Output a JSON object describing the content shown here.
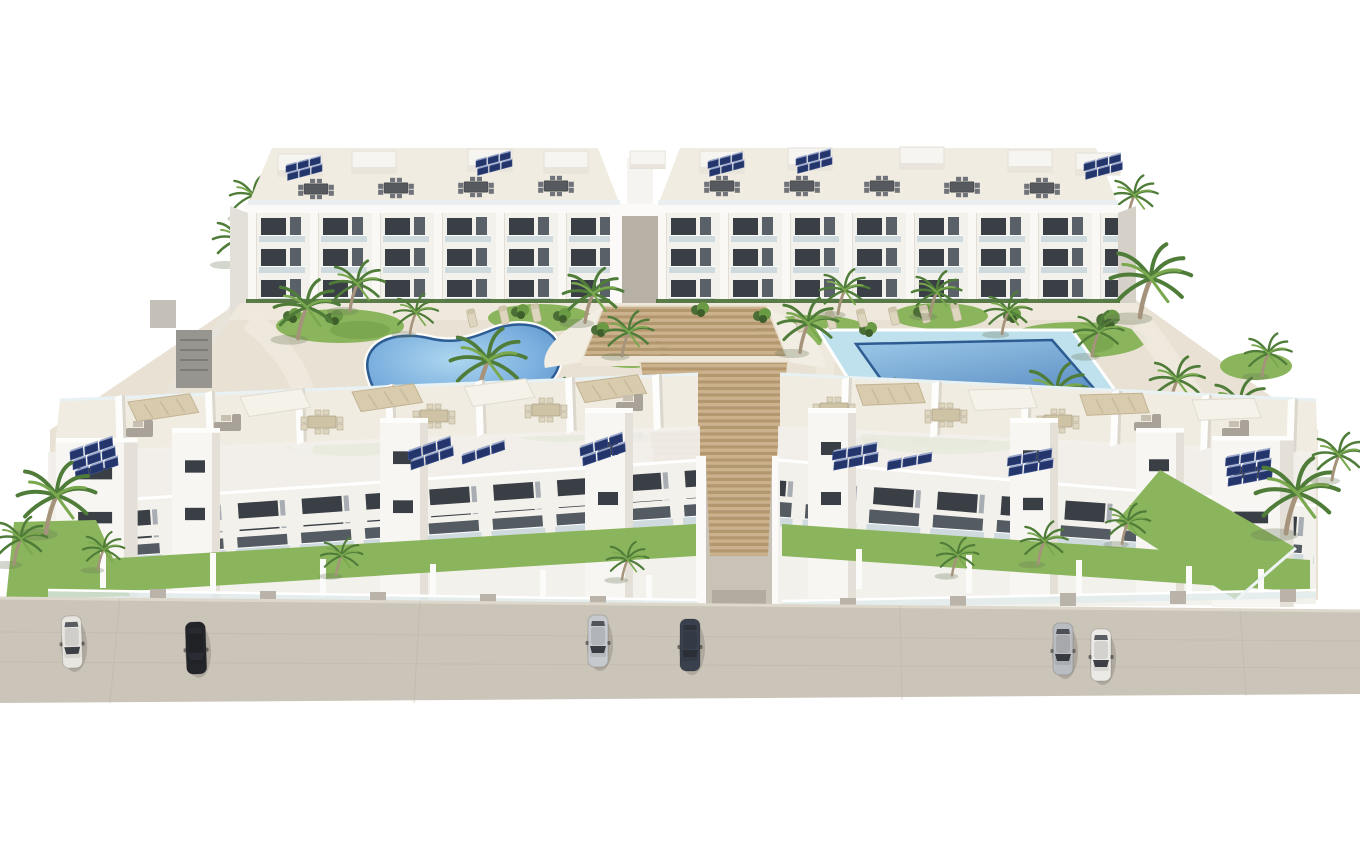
{
  "meta": {
    "type": "3d-architectural-render",
    "subject": "aerial rendering of a white residential apartment complex with two courtyard pools, central timber staircase, palm trees, rooftop solar panels and street parking",
    "view": "elevated three-quarter aerial view",
    "background": "plain white"
  },
  "palette": {
    "background": "#ffffff",
    "building_white": "#f3f1ec",
    "building_shade": "#e3e0d9",
    "building_dark_side": "#d5d1c8",
    "parapet_bright": "#fbfaf8",
    "roof_cream": "#f1ece1",
    "window_dark": "#3a3f46",
    "window_mid": "#555b62",
    "glass_balustrade": "#cfdade",
    "hedge_green": "#4a6e35",
    "grass_green": "#8ab55c",
    "grass_dark": "#6b9a44",
    "palm_green": "#4f7d39",
    "palm_green_light": "#7aa84f",
    "palm_trunk": "#a5937b",
    "pool_deck_blue": "#bfe0ed",
    "pool_rim": "#2d5c92",
    "wood_light": "#cbb18c",
    "wood_dark": "#b3976f",
    "path_cream": "#efe9dd",
    "ground_sand": "#e9e2d4",
    "street_gray": "#cbc4b8",
    "street_line": "#bdb5a8",
    "corridor_gray": "#c9c2b6",
    "perimeter_wall": "#e8e4dc",
    "solar_navy": "#24356b",
    "solar_cell": "#3b518f",
    "furniture_beige": "#cfc3a6",
    "furniture_dark": "#565a5f"
  },
  "scene": {
    "bg_palms": [
      {
        "s": "palm",
        "x": 247,
        "y": 216,
        "k": 0.9
      },
      {
        "s": "palm",
        "x": 1128,
        "y": 216,
        "k": 0.9
      },
      {
        "s": "palm",
        "x": 232,
        "y": 262,
        "k": 1.0
      }
    ],
    "roofboxes": [
      {
        "s": "roofbox",
        "x": 278,
        "y": 154
      },
      {
        "s": "roofbox",
        "x": 352,
        "y": 151
      },
      {
        "s": "roofbox",
        "x": 468,
        "y": 149
      },
      {
        "s": "roofbox",
        "x": 544,
        "y": 151
      },
      {
        "s": "roofbox",
        "x": 630,
        "y": 151,
        "k": 0.8
      },
      {
        "s": "roofbox",
        "x": 700,
        "y": 151
      },
      {
        "s": "roofbox",
        "x": 788,
        "y": 148
      },
      {
        "s": "roofbox",
        "x": 900,
        "y": 147
      },
      {
        "s": "roofbox",
        "x": 1008,
        "y": 150
      },
      {
        "s": "roofbox",
        "x": 1076,
        "y": 153
      }
    ],
    "back_solar": [
      {
        "s": "solar6",
        "x": 286,
        "y": 166,
        "k": 0.8
      },
      {
        "s": "solar6",
        "x": 476,
        "y": 161,
        "k": 0.8
      },
      {
        "s": "solar6",
        "x": 708,
        "y": 162,
        "k": 0.8
      },
      {
        "s": "solar6",
        "x": 796,
        "y": 159,
        "k": 0.8
      },
      {
        "s": "solar6",
        "x": 1084,
        "y": 164,
        "k": 0.85
      }
    ],
    "back_roof_furniture": [
      {
        "s": "dineD",
        "x": 316,
        "y": 189,
        "k": 0.85
      },
      {
        "s": "dineD",
        "x": 396,
        "y": 188,
        "k": 0.85
      },
      {
        "s": "dineD",
        "x": 476,
        "y": 187,
        "k": 0.85
      },
      {
        "s": "dineD",
        "x": 556,
        "y": 186,
        "k": 0.85
      },
      {
        "s": "dineD",
        "x": 722,
        "y": 186,
        "k": 0.85
      },
      {
        "s": "dineD",
        "x": 802,
        "y": 186,
        "k": 0.85
      },
      {
        "s": "dineD",
        "x": 882,
        "y": 186,
        "k": 0.85
      },
      {
        "s": "dineD",
        "x": 962,
        "y": 187,
        "k": 0.85
      },
      {
        "s": "dineD",
        "x": 1042,
        "y": 188,
        "k": 0.85
      }
    ],
    "courtyard_palms": [
      {
        "s": "palm",
        "x": 298,
        "y": 336,
        "k": 1.25
      },
      {
        "s": "palm",
        "x": 350,
        "y": 308,
        "k": 1.05
      },
      {
        "s": "palm",
        "x": 410,
        "y": 332,
        "k": 0.85
      },
      {
        "s": "palm",
        "x": 585,
        "y": 320,
        "k": 1.15
      },
      {
        "s": "palm",
        "x": 622,
        "y": 354,
        "k": 0.95
      },
      {
        "s": "palm",
        "x": 478,
        "y": 394,
        "k": 1.45
      },
      {
        "s": "palm",
        "x": 372,
        "y": 434,
        "k": 1.05
      },
      {
        "s": "palm",
        "x": 545,
        "y": 430,
        "k": 1.15
      },
      {
        "s": "palm",
        "x": 640,
        "y": 434,
        "k": 1.25
      },
      {
        "s": "palm",
        "x": 800,
        "y": 350,
        "k": 1.15
      },
      {
        "s": "palm",
        "x": 838,
        "y": 312,
        "k": 0.95
      },
      {
        "s": "palm",
        "x": 872,
        "y": 440,
        "k": 1.35
      },
      {
        "s": "palm",
        "x": 930,
        "y": 314,
        "k": 0.95
      },
      {
        "s": "palm",
        "x": 1002,
        "y": 332,
        "k": 0.9
      },
      {
        "s": "palm",
        "x": 1048,
        "y": 420,
        "k": 1.25
      },
      {
        "s": "palm",
        "x": 1092,
        "y": 354,
        "k": 0.95
      },
      {
        "s": "palm",
        "x": 1140,
        "y": 314,
        "k": 1.55
      },
      {
        "s": "palm",
        "x": 1170,
        "y": 404,
        "k": 1.05
      },
      {
        "s": "palm",
        "x": 1232,
        "y": 430,
        "k": 1.15
      },
      {
        "s": "palm",
        "x": 1262,
        "y": 374,
        "k": 0.9
      }
    ],
    "shrubs": [
      {
        "s": "shrub",
        "x": 292,
        "y": 316
      },
      {
        "s": "shrub",
        "x": 334,
        "y": 318
      },
      {
        "s": "shrub",
        "x": 520,
        "y": 312
      },
      {
        "s": "shrub",
        "x": 562,
        "y": 316
      },
      {
        "s": "shrub",
        "x": 700,
        "y": 310
      },
      {
        "s": "shrub",
        "x": 762,
        "y": 316
      },
      {
        "s": "shrub",
        "x": 922,
        "y": 312
      },
      {
        "s": "shrub",
        "x": 1012,
        "y": 316
      },
      {
        "s": "shrub",
        "x": 1108,
        "y": 320,
        "k": 1.3
      },
      {
        "s": "shrub",
        "x": 624,
        "y": 396
      },
      {
        "s": "shrub",
        "x": 684,
        "y": 424
      },
      {
        "s": "shrub",
        "x": 822,
        "y": 432
      },
      {
        "s": "shrub",
        "x": 982,
        "y": 430,
        "k": 1.2
      },
      {
        "s": "shrub",
        "x": 420,
        "y": 446
      },
      {
        "s": "shrub",
        "x": 600,
        "y": 330
      },
      {
        "s": "shrub",
        "x": 868,
        "y": 330
      }
    ],
    "loungers": [
      {
        "s": "lounger",
        "x": 800,
        "y": 323,
        "r": -14
      },
      {
        "s": "lounger",
        "x": 831,
        "y": 320,
        "r": -14
      },
      {
        "s": "lounger",
        "x": 862,
        "y": 318,
        "r": -14
      },
      {
        "s": "lounger",
        "x": 894,
        "y": 316,
        "r": -14
      },
      {
        "s": "lounger",
        "x": 925,
        "y": 314,
        "r": -14
      },
      {
        "s": "lounger",
        "x": 956,
        "y": 312,
        "r": -14
      },
      {
        "s": "lounger",
        "x": 472,
        "y": 318,
        "r": -12
      },
      {
        "s": "lounger",
        "x": 504,
        "y": 315,
        "r": -12
      },
      {
        "s": "lounger",
        "x": 536,
        "y": 313,
        "r": -12
      }
    ],
    "terrace_dividers": [
      {
        "s": "tdiv",
        "x": 115,
        "y": 397,
        "r": -2
      },
      {
        "s": "tdiv",
        "x": 205,
        "y": 393,
        "r": -2
      },
      {
        "s": "tdiv",
        "x": 295,
        "y": 390,
        "r": -2
      },
      {
        "s": "tdiv",
        "x": 385,
        "y": 386,
        "r": -2
      },
      {
        "s": "tdiv",
        "x": 475,
        "y": 382,
        "r": -2
      },
      {
        "s": "tdiv",
        "x": 565,
        "y": 379,
        "r": -2
      },
      {
        "s": "tdiv",
        "x": 652,
        "y": 376,
        "r": -2
      },
      {
        "s": "tdiv",
        "x": 842,
        "y": 379,
        "r": 2
      },
      {
        "s": "tdiv",
        "x": 932,
        "y": 383,
        "r": 2
      },
      {
        "s": "tdiv",
        "x": 1022,
        "y": 388,
        "r": 2
      },
      {
        "s": "tdiv",
        "x": 1112,
        "y": 392,
        "r": 2
      },
      {
        "s": "tdiv",
        "x": 1202,
        "y": 396,
        "r": 2
      },
      {
        "s": "tdiv",
        "x": 1288,
        "y": 400,
        "r": 2
      }
    ],
    "pergolas": [
      {
        "s": "pergB",
        "x": 128,
        "y": 402,
        "r": -3
      },
      {
        "s": "pergW",
        "x": 240,
        "y": 397,
        "r": -3
      },
      {
        "s": "pergB",
        "x": 352,
        "y": 392,
        "r": -3
      },
      {
        "s": "pergW",
        "x": 464,
        "y": 387,
        "r": -3
      },
      {
        "s": "pergB",
        "x": 576,
        "y": 383,
        "r": -3
      },
      {
        "s": "pergB",
        "x": 856,
        "y": 385,
        "r": 3
      },
      {
        "s": "pergW",
        "x": 968,
        "y": 390,
        "r": 3
      },
      {
        "s": "pergB",
        "x": 1080,
        "y": 395,
        "r": 3
      },
      {
        "s": "pergW",
        "x": 1192,
        "y": 400,
        "r": 3
      }
    ],
    "front_terrace_furniture": [
      {
        "s": "sofa",
        "x": 142,
        "y": 432
      },
      {
        "s": "sofa",
        "x": 230,
        "y": 426
      },
      {
        "s": "dineB",
        "x": 322,
        "y": 422
      },
      {
        "s": "dineB",
        "x": 434,
        "y": 416
      },
      {
        "s": "dineB",
        "x": 546,
        "y": 410
      },
      {
        "s": "sofa",
        "x": 632,
        "y": 406
      },
      {
        "s": "sofa",
        "x": 1238,
        "y": 432
      },
      {
        "s": "sofa",
        "x": 1150,
        "y": 426
      },
      {
        "s": "dineB",
        "x": 1058,
        "y": 421
      },
      {
        "s": "dineB",
        "x": 946,
        "y": 415
      },
      {
        "s": "dineB",
        "x": 834,
        "y": 409
      }
    ],
    "front_towers": [
      {
        "s": "tower",
        "x": 56,
        "y": 438,
        "k": 1.7,
        "ky": 0.88
      },
      {
        "s": "tower",
        "x": 172,
        "y": 428,
        "ky": 0.95
      },
      {
        "s": "tower",
        "x": 380,
        "y": 418,
        "ky": 0.98
      },
      {
        "s": "tower",
        "x": 585,
        "y": 408
      },
      {
        "s": "tower",
        "x": 808,
        "y": 408
      },
      {
        "s": "tower",
        "x": 1010,
        "y": 418,
        "ky": 0.95
      },
      {
        "s": "tower",
        "x": 1136,
        "y": 428,
        "ky": 0.92
      },
      {
        "s": "tower",
        "x": 1212,
        "y": 436,
        "k": 1.7,
        "ky": 0.9
      }
    ],
    "front_solar": [
      {
        "s": "solar9",
        "x": 70,
        "y": 452,
        "r": -4
      },
      {
        "s": "solar6",
        "x": 408,
        "y": 452,
        "r": -4
      },
      {
        "s": "solar3",
        "x": 462,
        "y": 456,
        "r": -4
      },
      {
        "s": "solar6",
        "x": 580,
        "y": 448,
        "r": -4
      },
      {
        "s": "solar6",
        "x": 833,
        "y": 452,
        "r": 4
      },
      {
        "s": "solar3",
        "x": 888,
        "y": 462,
        "r": 4
      },
      {
        "s": "solar6",
        "x": 1008,
        "y": 458,
        "r": 4
      },
      {
        "s": "solar9",
        "x": 1226,
        "y": 458,
        "r": 4
      }
    ],
    "garden_palms": [
      {
        "s": "palm",
        "x": 46,
        "y": 530,
        "k": 1.5
      },
      {
        "s": "palm",
        "x": 14,
        "y": 562,
        "k": 1.0
      },
      {
        "s": "palm",
        "x": 98,
        "y": 568,
        "k": 0.8
      },
      {
        "s": "palm",
        "x": 336,
        "y": 574,
        "k": 0.8
      },
      {
        "s": "palm",
        "x": 622,
        "y": 578,
        "k": 0.8
      },
      {
        "s": "palm",
        "x": 952,
        "y": 574,
        "k": 0.8
      },
      {
        "s": "palm",
        "x": 1038,
        "y": 562,
        "k": 0.9
      },
      {
        "s": "palm",
        "x": 1122,
        "y": 542,
        "k": 0.85
      },
      {
        "s": "palm",
        "x": 1286,
        "y": 530,
        "k": 1.6
      },
      {
        "s": "palm",
        "x": 1332,
        "y": 478,
        "k": 1.0
      }
    ],
    "cars": [
      {
        "s": "car",
        "x": 72,
        "y": 642,
        "c": "#e8e6e1",
        "r": -2,
        "n": "parked-car-white-left"
      },
      {
        "s": "car",
        "x": 196,
        "y": 648,
        "c": "#23252a",
        "r": -2,
        "n": "parked-car-black-left"
      },
      {
        "s": "car",
        "x": 598,
        "y": 641,
        "c": "#c6c9cd",
        "n": "parked-car-silver-center"
      },
      {
        "s": "car",
        "x": 690,
        "y": 645,
        "c": "#39414e",
        "n": "parked-car-darkgray-center"
      },
      {
        "s": "car",
        "x": 1063,
        "y": 649,
        "c": "#b9bcc0",
        "n": "parked-car-gray-right"
      },
      {
        "s": "car",
        "x": 1101,
        "y": 655,
        "c": "#eceae6",
        "n": "parked-car-white-right"
      }
    ]
  }
}
